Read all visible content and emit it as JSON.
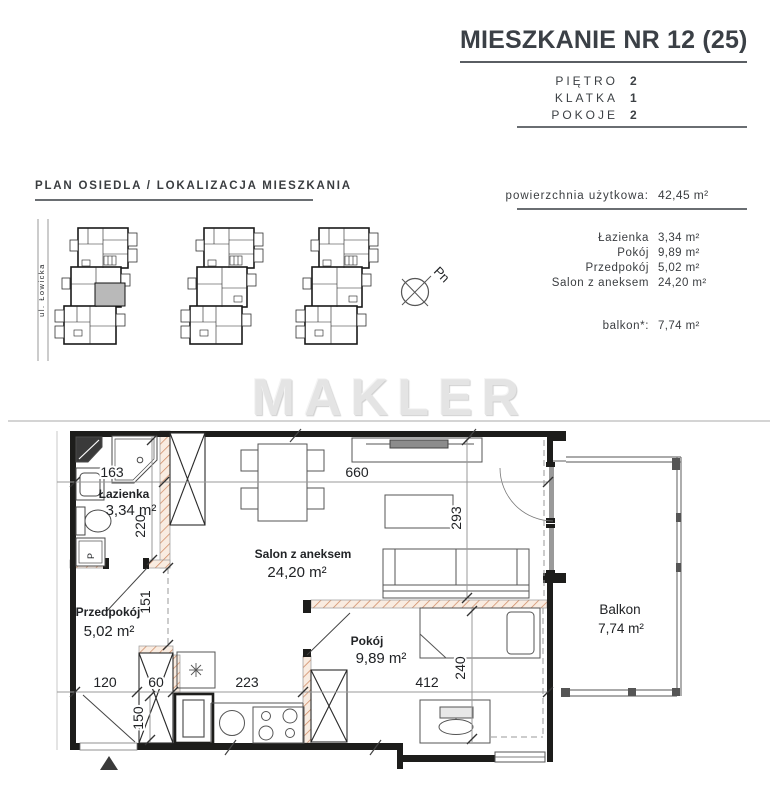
{
  "header": {
    "title": "MIESZKANIE NR 12 (25)",
    "rows": [
      {
        "label": "PIĘTRO",
        "value": "2"
      },
      {
        "label": "KLATKA",
        "value": "1"
      },
      {
        "label": "POKOJE",
        "value": "2"
      }
    ]
  },
  "site_plan": {
    "title": "PLAN OSIEDLA / LOKALIZACJA MIESZKANIA",
    "street": "ul. Łowicka",
    "compass": "Pn"
  },
  "areas": {
    "total_label": "powierzchnia użytkowa:",
    "total_value": "42,45 m²",
    "rooms": [
      {
        "name": "Łazienka",
        "value": "3,34 m²"
      },
      {
        "name": "Pokój",
        "value": "9,89 m²"
      },
      {
        "name": "Przedpokój",
        "value": "5,02 m²"
      },
      {
        "name": "Salon z aneksem",
        "value": "24,20 m²"
      }
    ],
    "balcony_label": "balkon*:",
    "balcony_value": "7,74 m²"
  },
  "watermark": "MAKLER",
  "plan": {
    "labels": {
      "lazienka": {
        "name": "Łazienka",
        "area": "3,34 m²"
      },
      "przedpokoj": {
        "name": "Przedpokój",
        "area": "5,02 m²"
      },
      "salon": {
        "name": "Salon z aneksem",
        "area": "24,20 m²"
      },
      "pokoj": {
        "name": "Pokój",
        "area": "9,89 m²"
      },
      "balkon": {
        "name": "Balkon",
        "area": "7,74 m²"
      }
    },
    "dims": {
      "w_bath": "163",
      "w_salon": "660",
      "h_bath": "220",
      "h_salon": "293",
      "h_hall": "151",
      "w_entry": "120",
      "w_shaft": "60",
      "h_shaft": "150",
      "w_kitchen": "223",
      "w_pokoj": "412",
      "h_pokoj": "240"
    },
    "washer": "P"
  },
  "colors": {
    "wall": "#1d1d1b",
    "hatch_line": "#cf8a64",
    "hatch_fill": "#f9ece1",
    "highlight_unit": "#b9b9b9",
    "watermark": "#e4e4e4"
  }
}
